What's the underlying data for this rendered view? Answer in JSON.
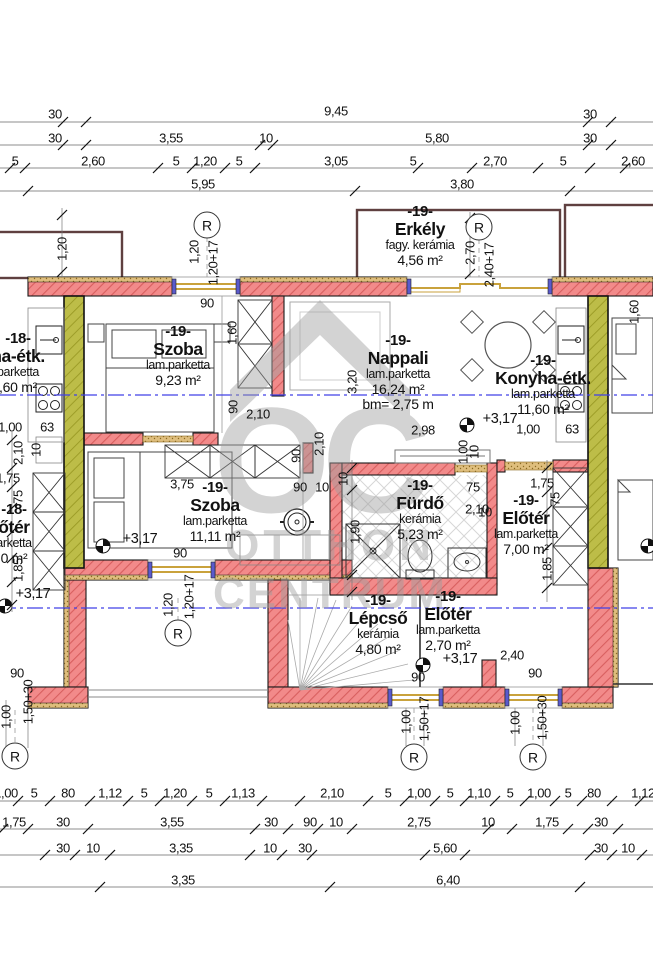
{
  "watermark": {
    "monogram": "OC",
    "line1": "OTTHON",
    "line2": "CENTRUM"
  },
  "grid_marker": "R",
  "rooms": [
    {
      "num": "-19-",
      "name": "Erkély",
      "finish": "fagy. kerámia",
      "area": "4,56 m²"
    },
    {
      "num": "-19-",
      "name": "Szoba",
      "finish": "lam.parketta",
      "area": "9,23 m²"
    },
    {
      "num": "-19-",
      "name": "Nappali",
      "finish": "lam.parketta",
      "area": "16,24 m²",
      "extra": "bm= 2,75 m"
    },
    {
      "num": "-19-",
      "name": "Konyha-étk.",
      "finish": "lam.parketta",
      "area": "11,60 m²"
    },
    {
      "num": "-19-",
      "name": "Szoba",
      "finish": "lam.parketta",
      "area": "11,11 m²"
    },
    {
      "num": "-19-",
      "name": "Fürdő",
      "finish": "kerámia",
      "area": "5,23 m²"
    },
    {
      "num": "-19-",
      "name": "Előtér",
      "finish": "lam.parketta",
      "area": "7,00 m²"
    },
    {
      "num": "-19-",
      "name": "Lépcső",
      "finish": "kerámia",
      "area": "4,80 m²"
    },
    {
      "num": "-19-",
      "name": "Előtér",
      "finish": "lam.parketta",
      "area": "2,70 m²"
    },
    {
      "num": "-18-",
      "name": "ha-étk.",
      "finish": "parketta",
      "area": ",60 m²"
    },
    {
      "num": "-18-",
      "name": "őtér",
      "finish": "arketta",
      "area": "0 m²"
    }
  ],
  "dims": [
    {
      "t": "30",
      "x": 55,
      "y": 114
    },
    {
      "t": "9,45",
      "x": 336,
      "y": 111
    },
    {
      "t": "30",
      "x": 590,
      "y": 114
    },
    {
      "t": "30",
      "x": 55,
      "y": 138
    },
    {
      "t": "3,55",
      "x": 171,
      "y": 138
    },
    {
      "t": "10",
      "x": 266,
      "y": 138
    },
    {
      "t": "5,80",
      "x": 437,
      "y": 138
    },
    {
      "t": "30",
      "x": 590,
      "y": 138
    },
    {
      "t": "5",
      "x": 15,
      "y": 161
    },
    {
      "t": "2,60",
      "x": 93,
      "y": 161
    },
    {
      "t": "5",
      "x": 176,
      "y": 161
    },
    {
      "t": "1,20",
      "x": 205,
      "y": 161
    },
    {
      "t": "5",
      "x": 239,
      "y": 161
    },
    {
      "t": "3,05",
      "x": 336,
      "y": 161
    },
    {
      "t": "5",
      "x": 413,
      "y": 161
    },
    {
      "t": "2,70",
      "x": 495,
      "y": 161
    },
    {
      "t": "5",
      "x": 563,
      "y": 161
    },
    {
      "t": "2,60",
      "x": 633,
      "y": 161
    },
    {
      "t": "5,95",
      "x": 203,
      "y": 184
    },
    {
      "t": "3,80",
      "x": 462,
      "y": 184
    },
    {
      "t": "1,00",
      "x": 6,
      "y": 793
    },
    {
      "t": "5",
      "x": 34,
      "y": 793
    },
    {
      "t": "80",
      "x": 68,
      "y": 793
    },
    {
      "t": "1,12",
      "x": 110,
      "y": 793
    },
    {
      "t": "5",
      "x": 144,
      "y": 793
    },
    {
      "t": "1,20",
      "x": 175,
      "y": 793
    },
    {
      "t": "5",
      "x": 209,
      "y": 793
    },
    {
      "t": "1,13",
      "x": 243,
      "y": 793
    },
    {
      "t": "2,10",
      "x": 332,
      "y": 793
    },
    {
      "t": "5",
      "x": 388,
      "y": 793
    },
    {
      "t": "1,00",
      "x": 419,
      "y": 793
    },
    {
      "t": "5",
      "x": 450,
      "y": 793
    },
    {
      "t": "1,10",
      "x": 479,
      "y": 793
    },
    {
      "t": "5",
      "x": 510,
      "y": 793
    },
    {
      "t": "1,00",
      "x": 539,
      "y": 793
    },
    {
      "t": "5",
      "x": 568,
      "y": 793
    },
    {
      "t": "80",
      "x": 594,
      "y": 793
    },
    {
      "t": "1,12",
      "x": 643,
      "y": 793
    },
    {
      "t": "1,75",
      "x": 14,
      "y": 822
    },
    {
      "t": "30",
      "x": 63,
      "y": 822
    },
    {
      "t": "3,55",
      "x": 172,
      "y": 822
    },
    {
      "t": "30",
      "x": 271,
      "y": 822
    },
    {
      "t": "90",
      "x": 310,
      "y": 822
    },
    {
      "t": "10",
      "x": 336,
      "y": 822
    },
    {
      "t": "2,75",
      "x": 419,
      "y": 822
    },
    {
      "t": "10",
      "x": 488,
      "y": 822
    },
    {
      "t": "1,75",
      "x": 547,
      "y": 822
    },
    {
      "t": "30",
      "x": 601,
      "y": 822
    },
    {
      "t": "30",
      "x": 63,
      "y": 848
    },
    {
      "t": "10",
      "x": 93,
      "y": 848
    },
    {
      "t": "3,35",
      "x": 181,
      "y": 848
    },
    {
      "t": "10",
      "x": 270,
      "y": 848
    },
    {
      "t": "30",
      "x": 305,
      "y": 848
    },
    {
      "t": "5,60",
      "x": 445,
      "y": 848
    },
    {
      "t": "30",
      "x": 601,
      "y": 848
    },
    {
      "t": "10",
      "x": 628,
      "y": 848
    },
    {
      "t": "3,35",
      "x": 183,
      "y": 880
    },
    {
      "t": "6,40",
      "x": 448,
      "y": 880
    },
    {
      "t": "90",
      "x": 207,
      "y": 303
    },
    {
      "t": "2,10",
      "x": 258,
      "y": 414
    },
    {
      "t": "90",
      "x": 300,
      "y": 487
    },
    {
      "t": "10",
      "x": 322,
      "y": 487
    },
    {
      "t": "2,98",
      "x": 423,
      "y": 430
    },
    {
      "t": "1,00",
      "x": 528,
      "y": 429
    },
    {
      "t": "63",
      "x": 572,
      "y": 429
    },
    {
      "t": "1,00",
      "x": 10,
      "y": 427
    },
    {
      "t": "63",
      "x": 47,
      "y": 427
    },
    {
      "t": "3,75",
      "x": 182,
      "y": 484
    },
    {
      "t": "90",
      "x": 180,
      "y": 553
    },
    {
      "t": "75",
      "x": 473,
      "y": 487
    },
    {
      "t": "2,10",
      "x": 477,
      "y": 509
    },
    {
      "t": "1,75",
      "x": 542,
      "y": 483
    },
    {
      "t": "10",
      "x": 485,
      "y": 512
    },
    {
      "t": "90",
      "x": 418,
      "y": 677
    },
    {
      "t": "2,40",
      "x": 512,
      "y": 655
    },
    {
      "t": "90",
      "x": 535,
      "y": 673
    },
    {
      "t": "90",
      "x": 17,
      "y": 673
    },
    {
      "t": "1,75",
      "x": 8,
      "y": 478
    },
    {
      "t": "1,60",
      "x": 232,
      "y": 333,
      "v": 1
    },
    {
      "t": "90",
      "x": 233,
      "y": 407,
      "v": 1
    },
    {
      "t": "90",
      "x": 296,
      "y": 456,
      "v": 1
    },
    {
      "t": "2,10",
      "x": 319,
      "y": 444,
      "v": 1
    },
    {
      "t": "3,20",
      "x": 352,
      "y": 382,
      "v": 1
    },
    {
      "t": "1,90",
      "x": 355,
      "y": 532,
      "v": 1
    },
    {
      "t": "10",
      "x": 343,
      "y": 479,
      "v": 1
    },
    {
      "t": "75",
      "x": 555,
      "y": 499,
      "v": 1
    },
    {
      "t": "1,85",
      "x": 547,
      "y": 569,
      "v": 1
    },
    {
      "t": "1,20",
      "x": 62,
      "y": 249,
      "v": 1
    },
    {
      "t": "1,20",
      "x": 194,
      "y": 252,
      "v": 1
    },
    {
      "t": "1,20+17",
      "x": 213,
      "y": 263,
      "v": 1
    },
    {
      "t": "2,70",
      "x": 470,
      "y": 253,
      "v": 1
    },
    {
      "t": "2,40+17",
      "x": 489,
      "y": 265,
      "v": 1
    },
    {
      "t": "1,20",
      "x": 168,
      "y": 605,
      "v": 1
    },
    {
      "t": "1,20+17",
      "x": 189,
      "y": 597,
      "v": 1
    },
    {
      "t": "1,00",
      "x": 406,
      "y": 722,
      "v": 1
    },
    {
      "t": "1,50+17",
      "x": 424,
      "y": 719,
      "v": 1
    },
    {
      "t": "1,00",
      "x": 515,
      "y": 723,
      "v": 1
    },
    {
      "t": "1,50+30",
      "x": 542,
      "y": 718,
      "v": 1
    },
    {
      "t": "1,50+30",
      "x": 28,
      "y": 702,
      "v": 1
    },
    {
      "t": "1,00",
      "x": 6,
      "y": 717,
      "v": 1
    },
    {
      "t": "2,10",
      "x": 18,
      "y": 453,
      "v": 1
    },
    {
      "t": "10",
      "x": 36,
      "y": 450,
      "v": 1
    },
    {
      "t": "75",
      "x": 18,
      "y": 497,
      "v": 1
    },
    {
      "t": "1,85",
      "x": 18,
      "y": 570,
      "v": 1
    },
    {
      "t": "1,00",
      "x": 463,
      "y": 452,
      "v": 1
    },
    {
      "t": "10",
      "x": 474,
      "y": 452,
      "v": 1
    },
    {
      "t": "1,60",
      "x": 634,
      "y": 312,
      "v": 1
    },
    {
      "t": "+3,17",
      "x": 500,
      "y": 419,
      "big": 1
    },
    {
      "t": "+3,17",
      "x": 140,
      "y": 539,
      "big": 1
    },
    {
      "t": "+3,17",
      "x": 460,
      "y": 659,
      "big": 1
    },
    {
      "t": "+3,17",
      "x": 33,
      "y": 594,
      "big": 1
    }
  ]
}
